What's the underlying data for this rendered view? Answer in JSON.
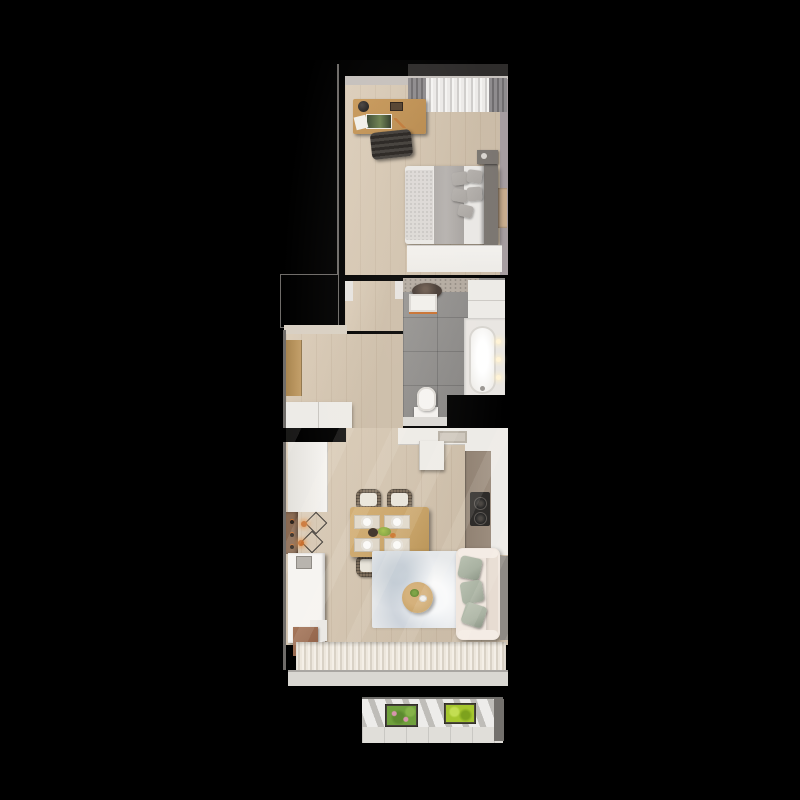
{
  "scene": {
    "title": "Narrow one-bedroom apartment — top-down 3D floor plan render on black background",
    "rooms": [
      {
        "id": "bedroom",
        "label": "Bedroom",
        "furniture": [
          "wood-desk",
          "desk-lamp",
          "picture-frame",
          "papers",
          "desk-chair",
          "window-curtain-panels",
          "window-sheer-curtain",
          "double-bed",
          "gray-blanket",
          "textured-throw",
          "bed-pillows",
          "headboard",
          "nightstand",
          "wall-art",
          "white-wardrobe"
        ]
      },
      {
        "id": "bathroom",
        "label": "Bathroom",
        "furniture": [
          "speckled-counter",
          "dark-round-basin",
          "white-vanity-unit",
          "tall-white-cabinet",
          "bathtub",
          "tub-faucet",
          "wall-lights",
          "toilet",
          "gray-floor-tiles"
        ]
      },
      {
        "id": "entry-hall",
        "label": "Entry hall",
        "furniture": [
          "door-frame",
          "wood-wardrobe-panel",
          "white-sideboard"
        ]
      },
      {
        "id": "living-kitchen",
        "label": "Living room with open kitchen",
        "furniture": [
          "top-counter-with-sink",
          "tall-kitchen-cabinet",
          "right-counter-taupe-top",
          "two-burner-cooktop",
          "left-upper-cabinet",
          "wood-backsplash-with-bottles",
          "wire-pendant-lights",
          "left-counter-run",
          "brown-base-cabinet",
          "dining-table",
          "rattan-chairs",
          "placemats-with-plates",
          "salad-centerpiece",
          "area-rug",
          "round-coffee-table",
          "cream-sofa",
          "sage-pillows",
          "sheer-window-curtain",
          "window-sill"
        ]
      },
      {
        "id": "balcony",
        "label": "Balcony",
        "furniture": [
          "concrete-floor",
          "planter-with-pink-flowers",
          "planter-with-lime-plants",
          "railing-ledge",
          "side-column"
        ]
      }
    ],
    "counts": {
      "dining_chairs": 4,
      "place_settings": 4,
      "sofa_pillows": 3,
      "bed_pillows": 5,
      "pendant_lights": 2,
      "bathroom_wall_lights": 3,
      "cooktop_burners": 2,
      "planters": 2
    }
  },
  "colors": {
    "bg": "#000000",
    "wood": "#d8c8b2",
    "wall_light": "#c6c1bd",
    "wall_mauve": "#a69da0",
    "wall_cream": "#d9d0c3",
    "edge": "#6f6c69",
    "tile": "#8f8d8b",
    "white_furn": "#edebe7",
    "white_bright": "#f6f4f1",
    "desk_wood": "#c89a5c",
    "curtain_gray": "#8f8c8e",
    "curtain_sheer": "#eceae8",
    "mattress": "#eae8e5",
    "blanket": "#b6b2af",
    "pillow_gray": "#a8a4a0",
    "headboard": "#7b7671",
    "throw": "#dcd9d6",
    "sink_dark": "#453a33",
    "accent_orange": "#c9702f",
    "tub": "#efede9",
    "glow": "#fff3d6",
    "counter_taupe": "#9c8d7e",
    "cooktop": "#2c2a28",
    "table_wood": "#c8a368",
    "placemat": "#ded6c8",
    "rattan": "#7c6c5a",
    "rug": "#e4e7ea",
    "sofa_cream": "#f0e7df",
    "pillow_sage": "#a9b2a2",
    "backsplash": "#8a6a52",
    "cabinet_wood": "#c4a06a",
    "cabinet_brown": "#a5765a",
    "balcony_floor": "#d7d5d0",
    "planter_green": "#6fa03c",
    "planter_lime": "#a6c72e",
    "flower_pink": "#d795ad",
    "sill": "#d9d7d2",
    "art_tan": "#c8ac8e"
  }
}
